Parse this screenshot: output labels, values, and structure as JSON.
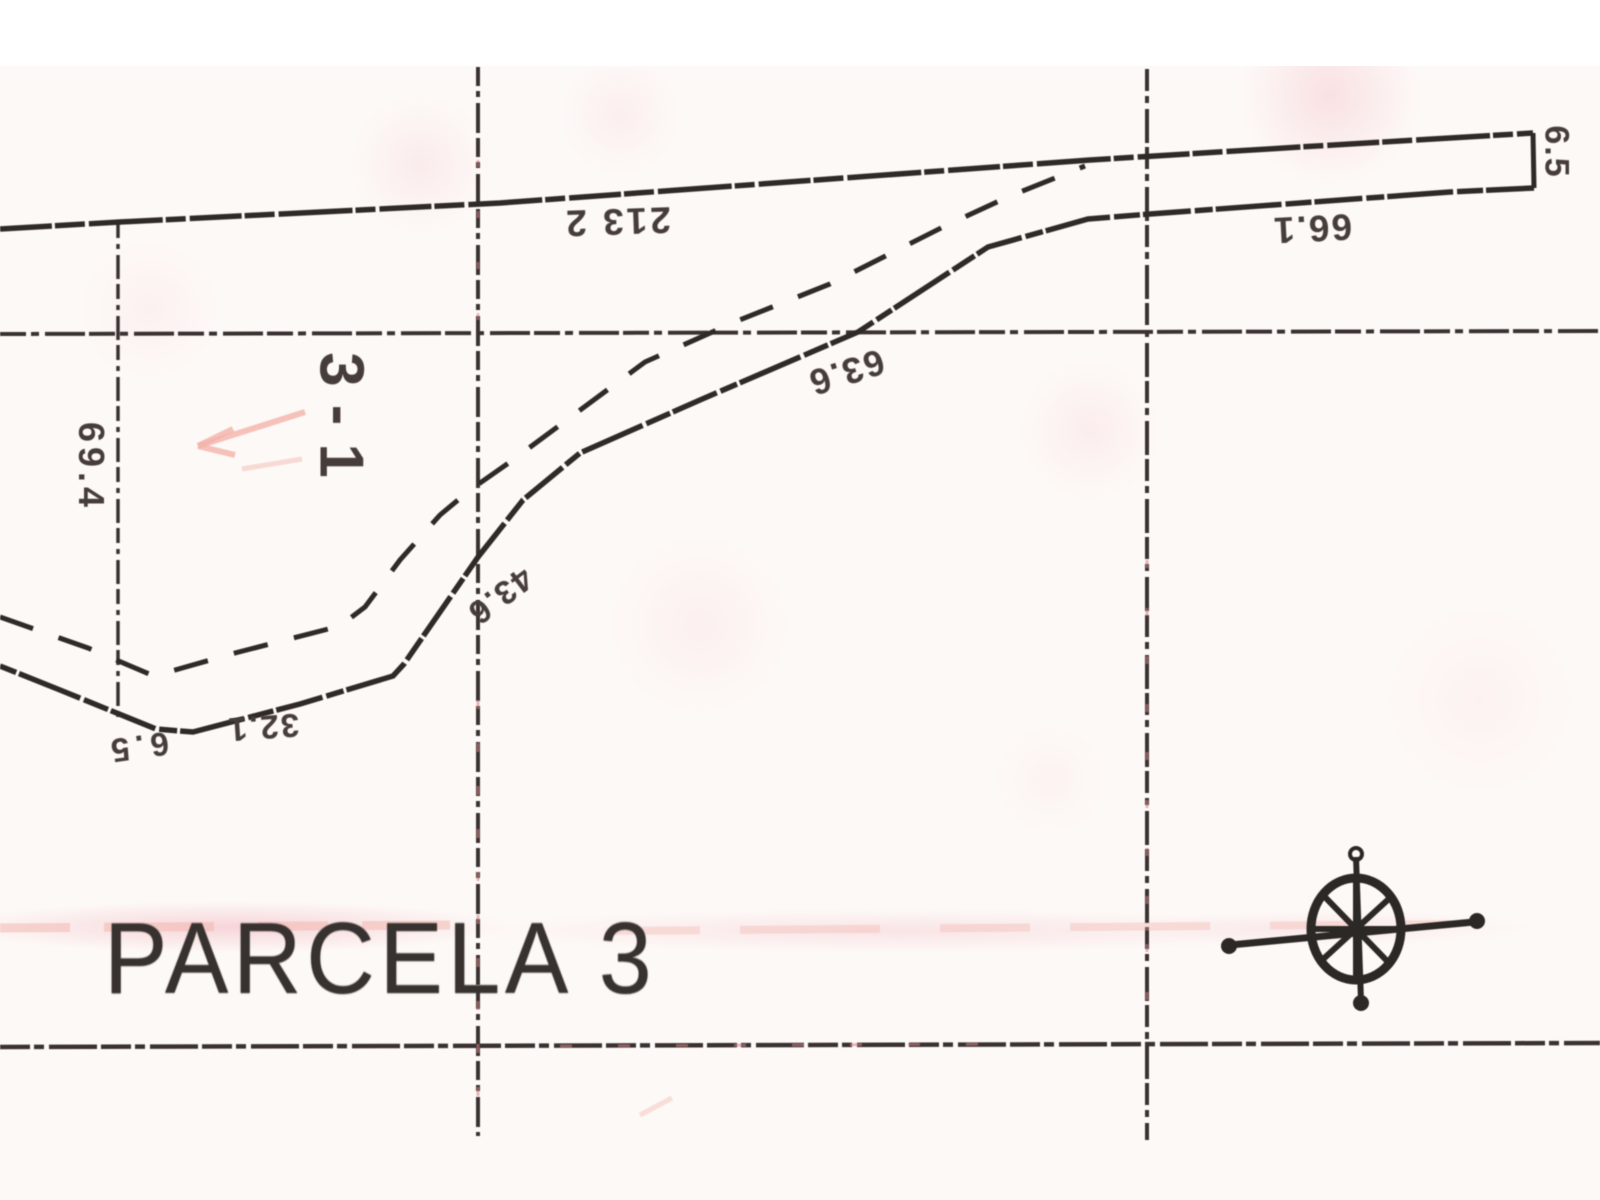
{
  "map": {
    "parcel_label": "PARCELA 3",
    "zone_label": "3-1",
    "measurements": {
      "strip_width_right": "6.5",
      "top_boundary": "213 2",
      "strip_lower_edge": "66.1",
      "upper_diagonal": "63.6",
      "mid_diagonal": "43.6",
      "left_grid_segment": "69.4",
      "vertex_width": "6.5",
      "lower_segment": "32.1"
    },
    "icons": {
      "compass": "compass-rose"
    },
    "colors": {
      "ink": "#2f2a27",
      "paper": "#fdf9f7",
      "artifact_pink": "#f2b3b9"
    }
  }
}
